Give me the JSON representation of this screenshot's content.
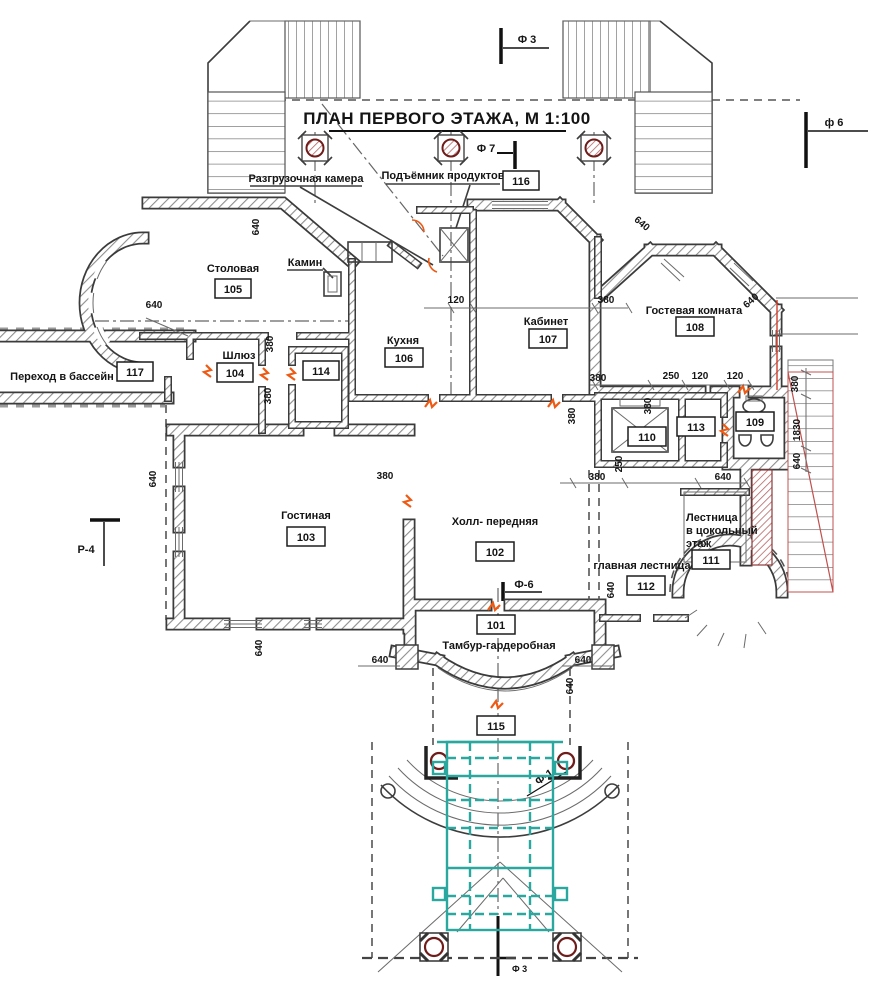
{
  "title": "ПЛАН ПЕРВОГО ЭТАЖА, М 1:100",
  "rooms": {
    "dining": {
      "label": "Столовая",
      "number": "105"
    },
    "airlock": {
      "label": "Шлюз",
      "number": "104"
    },
    "kitchen": {
      "label": "Кухня",
      "number": "106"
    },
    "study": {
      "label": "Кабинет",
      "number": "107"
    },
    "guest": {
      "label": "Гостевая комната",
      "number": "108"
    },
    "wc": {
      "number": "109"
    },
    "elevator": {
      "number": "110"
    },
    "basement_stair": {
      "label_line1": "Лестница",
      "label_line2": "в цокольный",
      "label_line3": "этаж",
      "number": "111"
    },
    "main_stair": {
      "label": "главная лестница",
      "number": "112"
    },
    "room113": {
      "number": "113"
    },
    "room114": {
      "number": "114"
    },
    "living": {
      "label": "Гостиная",
      "number": "103"
    },
    "hall": {
      "label": "Холл- передняя",
      "number": "102"
    },
    "vestibule": {
      "label": "Тамбур-гардеробная",
      "number": "101"
    },
    "porch": {
      "number": "115"
    },
    "room116": {
      "number": "116"
    },
    "pool_passage": {
      "label": "Переход в бассейн",
      "number": "117"
    }
  },
  "callouts": {
    "unloading": "Разгрузочная камера",
    "food_lift": "Подъёмник продуктов",
    "fireplace": "Камин"
  },
  "markers": {
    "f3_top": "Ф 3",
    "f6_top": "ф 6",
    "f7": "Ф 7",
    "f6_mid": "Ф-6",
    "f1": "Ф-1",
    "r4": "Р-4",
    "f3_bottom": "Ф 3"
  },
  "dimensions": {
    "d640": "640",
    "d380": "380",
    "d120": "120",
    "d250": "250",
    "d1830": "1830"
  },
  "colors": {
    "teal": "#2aa89f",
    "door_orange": "#ee5a13",
    "column_red": "#6f1d1b",
    "stair_red": "#c0504d",
    "wall_dark": "#3b3b3b"
  }
}
